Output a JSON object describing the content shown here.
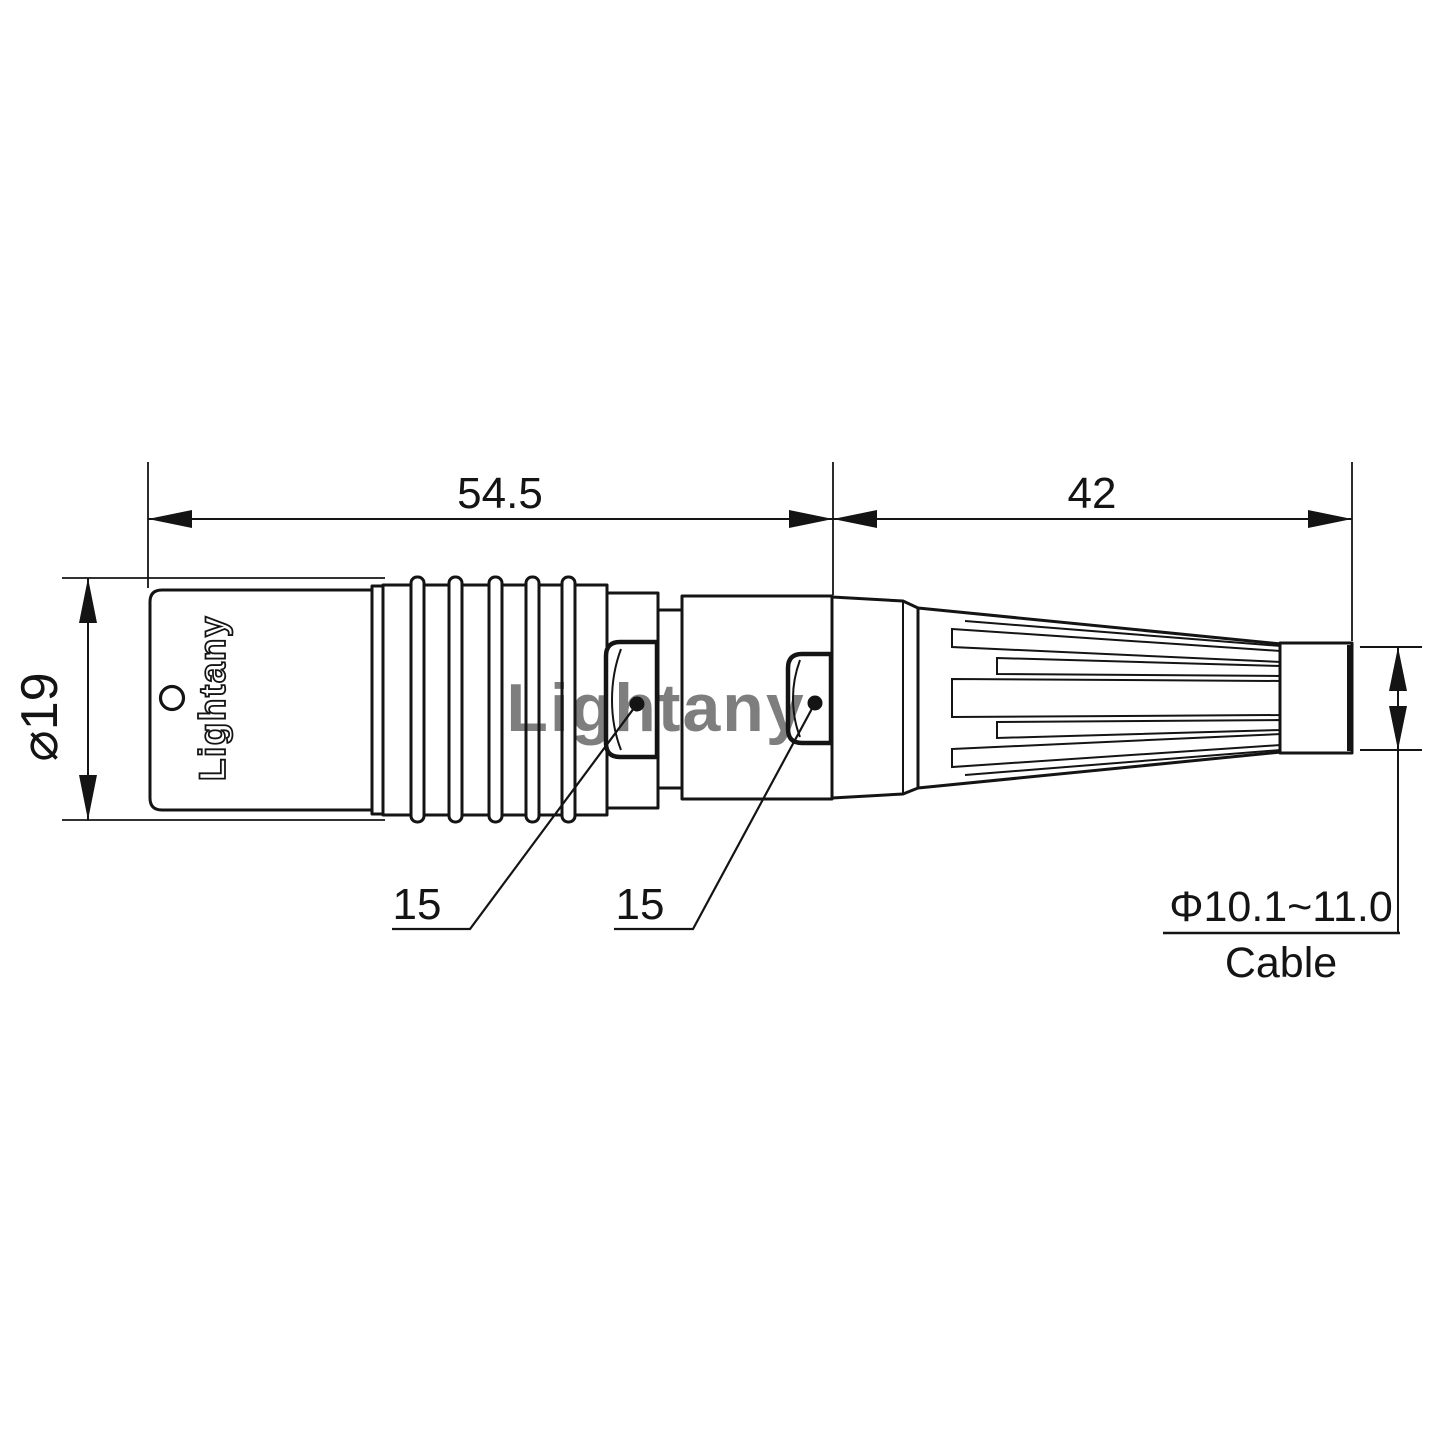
{
  "drawing": {
    "watermark": "Lightany",
    "body_logo": "Lightany",
    "dims": {
      "front_section_length": "54.5",
      "rear_section_length": "42",
      "shell_diameter": "⌀19",
      "front_wrench_flats": "15",
      "rear_wrench_flats": "15",
      "cable_diameter_range": "Φ10.1~11.0",
      "cable_word": "Cable"
    },
    "colors": {
      "ink": "#141414",
      "watermark_pink": "#ef9fa6",
      "background": "#ffffff"
    }
  }
}
